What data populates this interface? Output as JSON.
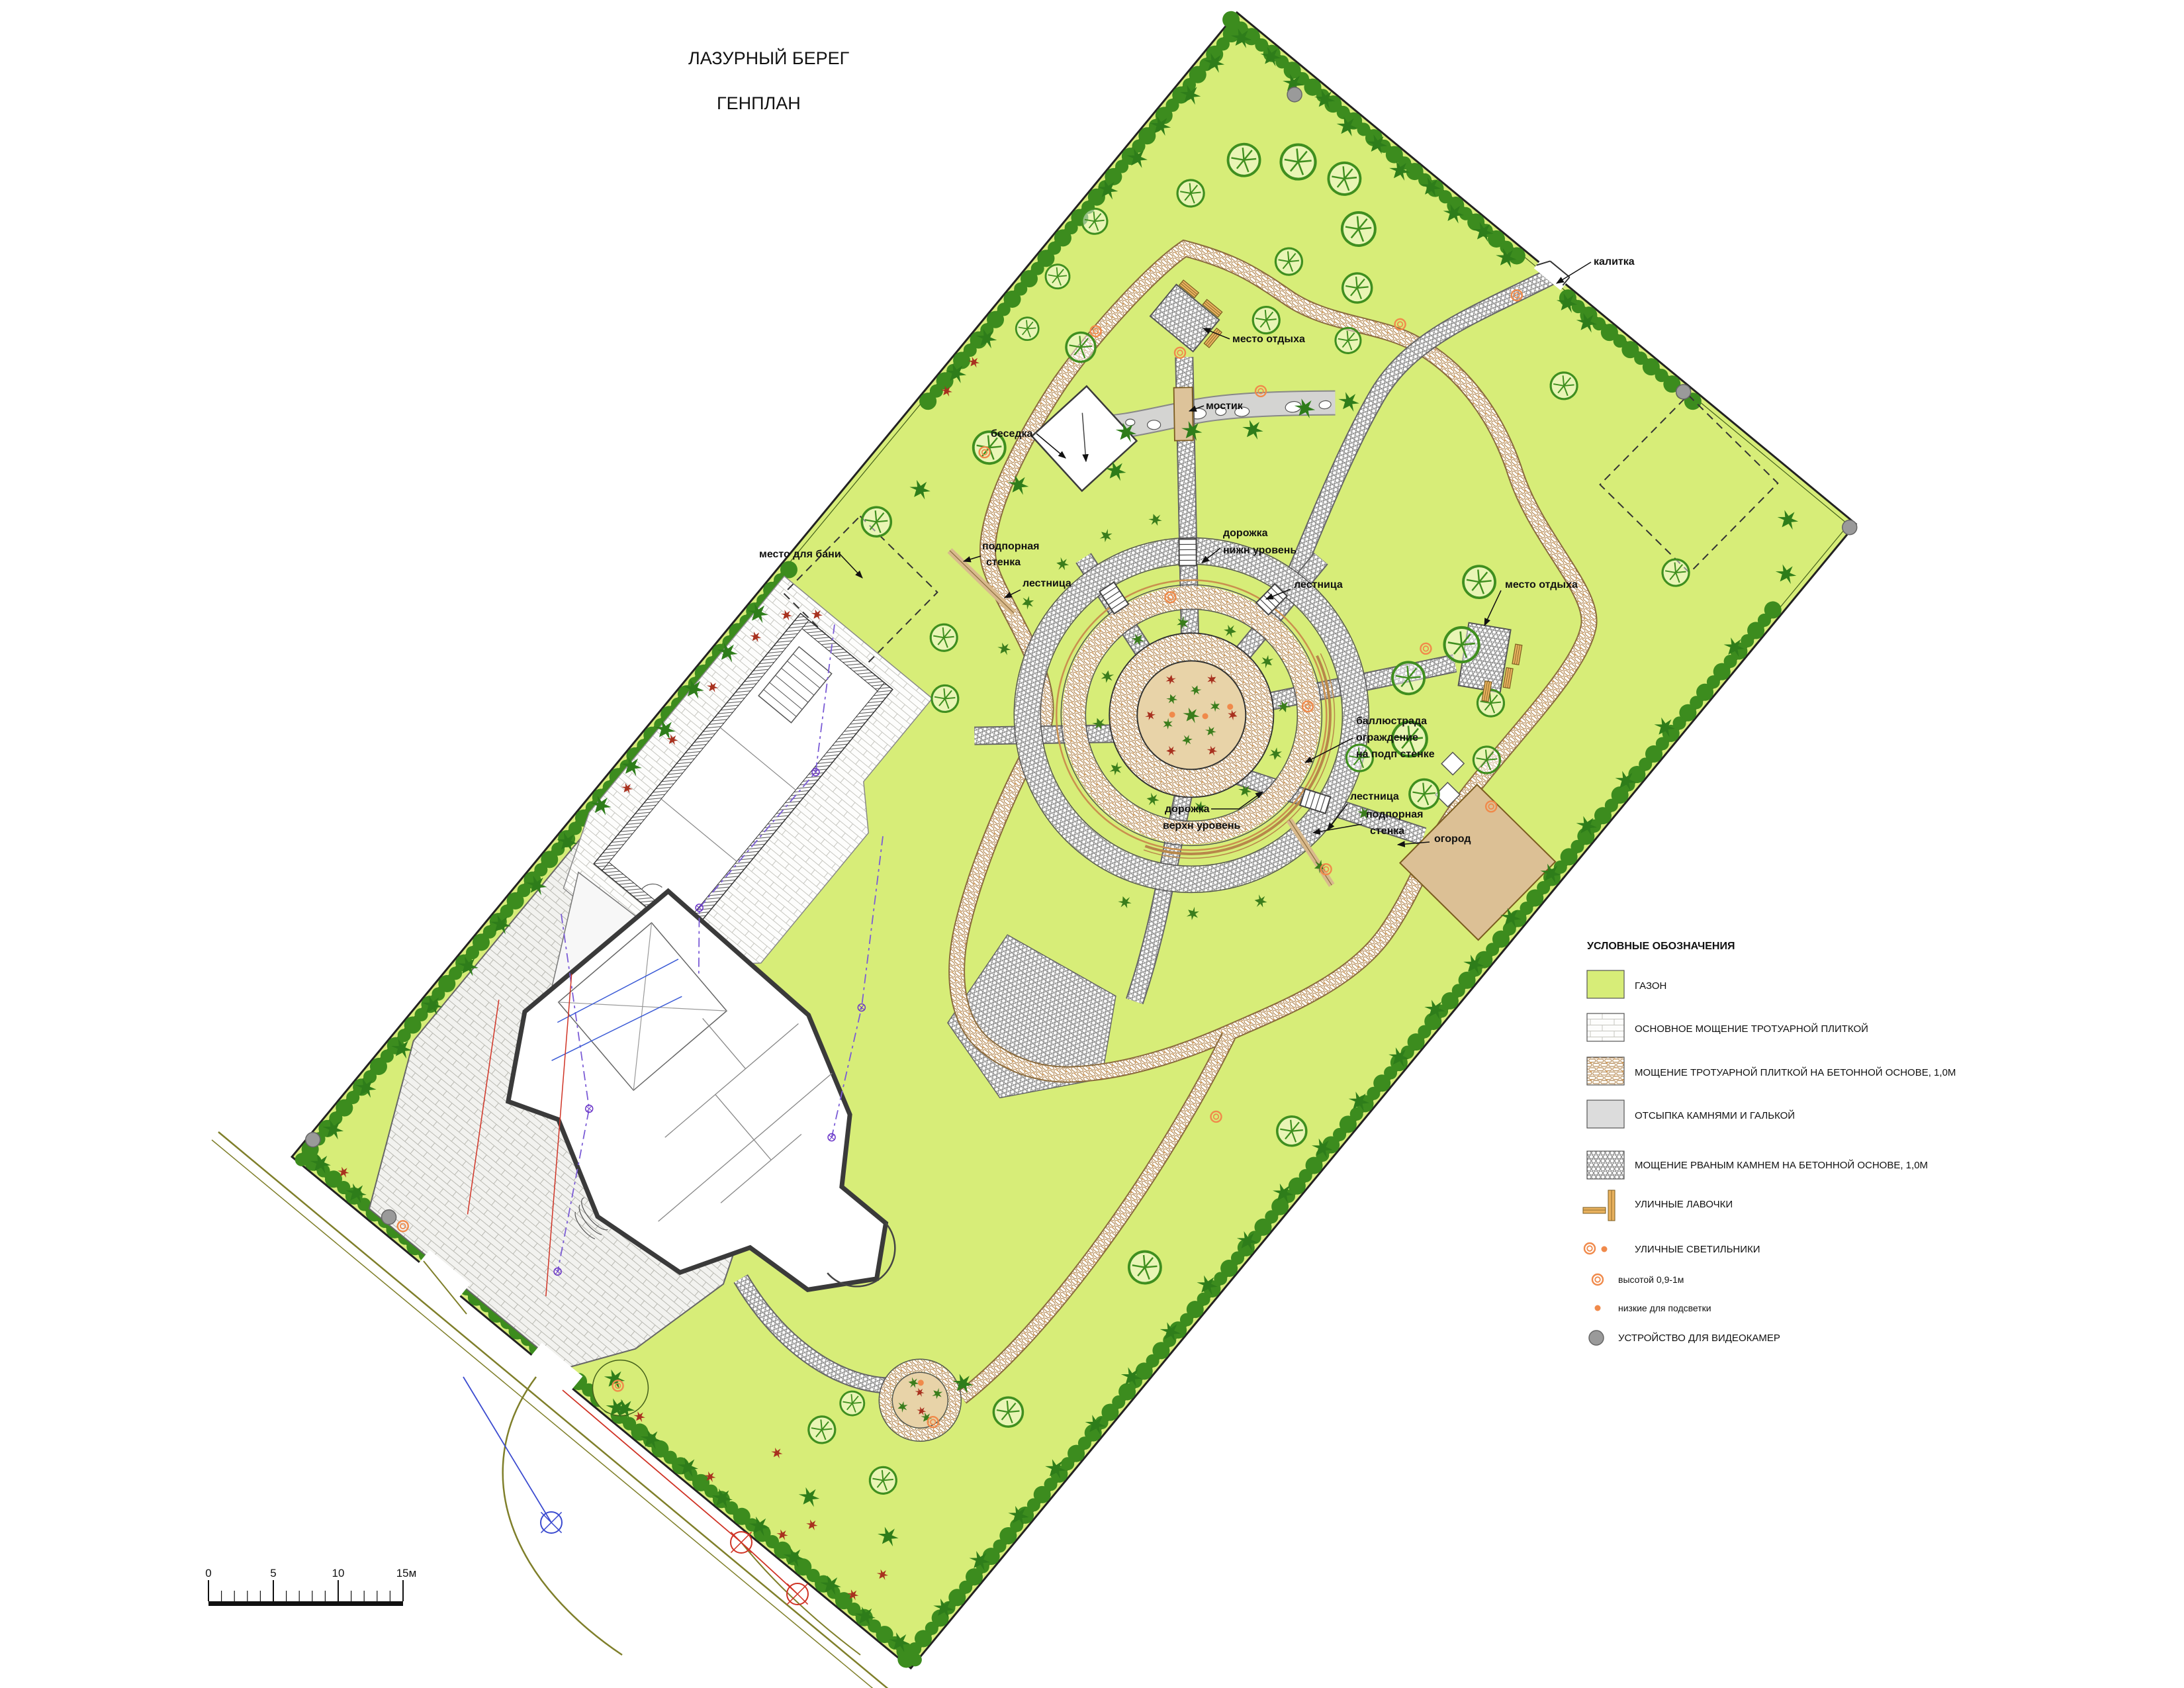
{
  "title": {
    "line1": "ЛАЗУРНЫЙ БЕРЕГ",
    "line2": "ГЕНПЛАН"
  },
  "plan_labels": {
    "gate": "калитка",
    "rest_top": "место отдыха",
    "bridge": "мостик",
    "gazebo": "беседка",
    "bath": "место для бани",
    "wall1a": "подпорная",
    "wall1b": "стенка",
    "stairs1": "лестница",
    "path_low_a": "дорожка",
    "path_low_b": "нижн уровень",
    "stairs2": "лестница",
    "rest_right": "место отдыха",
    "balu_a": "баллюстрада",
    "balu_b": "ограждение",
    "balu_c": "на подп стенке",
    "stairs3": "лестница",
    "wall2a": "подпорная",
    "wall2b": "стенка",
    "garden": "огород",
    "path_up_a": "дорожка",
    "path_up_b": "верхн уровень"
  },
  "legend": {
    "heading": "УСЛОВНЫЕ ОБОЗНАЧЕНИЯ",
    "items": [
      {
        "label": "ГАЗОН"
      },
      {
        "label": "ОСНОВНОЕ МОЩЕНИЕ ТРОТУАРНОЙ ПЛИТКОЙ"
      },
      {
        "label": "МОЩЕНИЕ ТРОТУАРНОЙ ПЛИТКОЙ НА БЕТОННОЙ ОСНОВЕ, 1,0М"
      },
      {
        "label": "ОТСЫПКА КАМНЯМИ И ГАЛЬКОЙ"
      },
      {
        "label": "МОЩЕНИЕ РВАНЫМ КАМНЕМ НА БЕТОННОЙ ОСНОВЕ, 1,0М"
      },
      {
        "label": "УЛИЧНЫЕ ЛАВОЧКИ"
      },
      {
        "label": "УЛИЧНЫЕ СВЕТИЛЬНИКИ"
      },
      {
        "label": "высотой 0,9-1м"
      },
      {
        "label": "низкие для подсветки"
      },
      {
        "label": "УСТРОЙСТВО ДЛЯ ВИДЕОКАМЕР"
      }
    ]
  },
  "scalebar": {
    "t0": "0",
    "t5": "5",
    "t10": "10",
    "t15": "15м"
  },
  "colors": {
    "lawn": "#d7ed78",
    "path_tan": "#b8874a",
    "ground_tan": "#e8d3a8",
    "garden_tan": "#dcc095",
    "lamp_orange": "#f08a4b",
    "camera_gray": "#9a9a9a",
    "conifer_green": "#2e7d1a",
    "bush_red": "#a8311f"
  }
}
